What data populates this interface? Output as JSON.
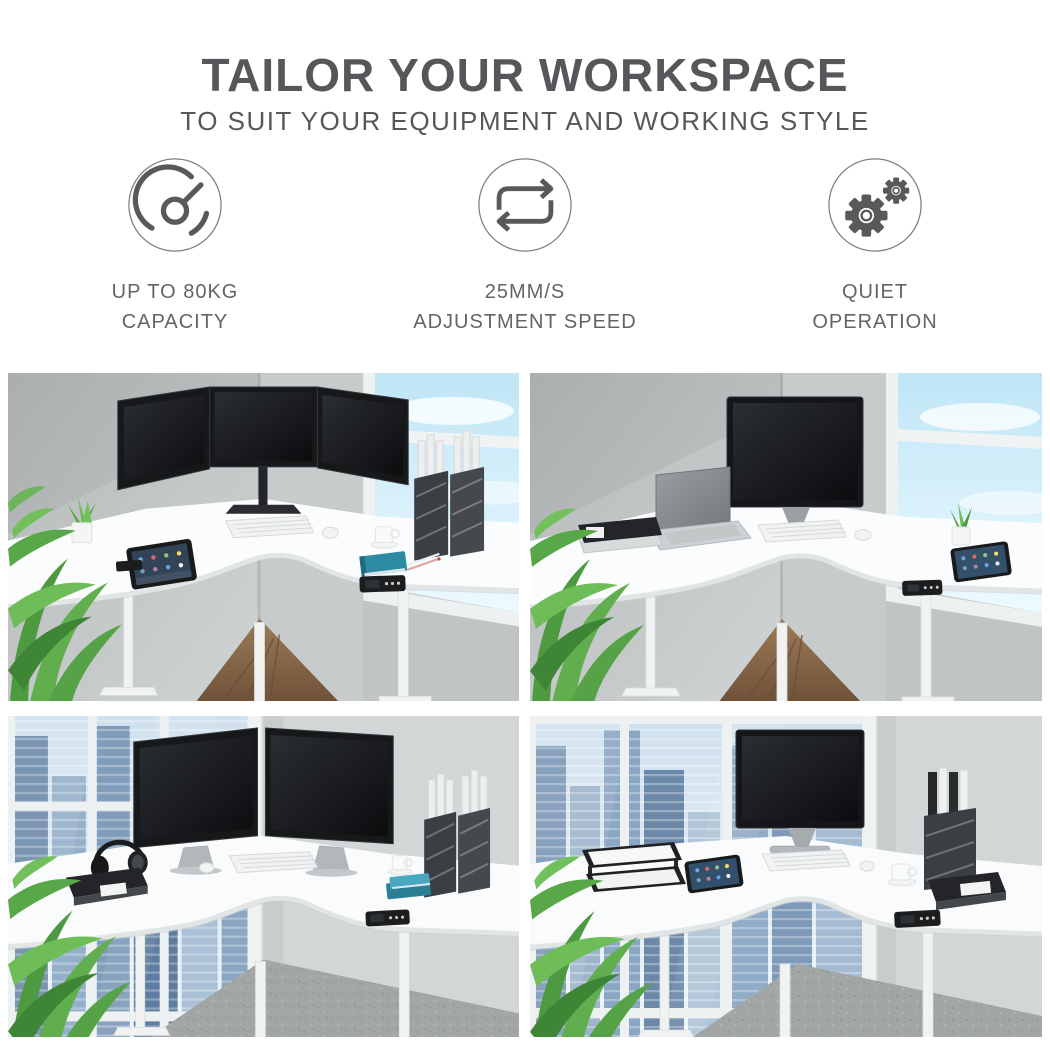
{
  "header": {
    "title": "TAILOR YOUR WORKSPACE",
    "subtitle": "TO SUIT YOUR EQUIPMENT AND WORKING STYLE"
  },
  "features": [
    {
      "icon": "speedometer-icon",
      "line1": "UP TO 80KG",
      "line2": "CAPACITY"
    },
    {
      "icon": "cycle-arrows-icon",
      "line1": "25MM/S",
      "line2": "ADJUSTMENT SPEED"
    },
    {
      "icon": "gears-icon",
      "line1": "QUIET",
      "line2": "OPERATION"
    }
  ],
  "gallery": [
    {
      "name": "triple-monitor-corner-desk",
      "alt": "White corner standing desk with triple monitor mount, tablet, keyboard, coffee cup and magazine files beside a bright window"
    },
    {
      "name": "monitor-and-laptop-corner-desk",
      "alt": "White corner standing desk with a large monitor, open laptop, black binders, small plant and tablet beside a bright window"
    },
    {
      "name": "dual-monitor-corner-desk",
      "alt": "White corner standing desk with two monitors, headphones, binder and magazine files in front of a floor-to-ceiling city window"
    },
    {
      "name": "single-monitor-corner-desk",
      "alt": "White corner standing desk with one monitor, stacked document trays, tablet, coffee cup and binder in front of a floor-to-ceiling city window"
    }
  ],
  "palette": {
    "heading_text": "#56575b",
    "feature_text": "#636468",
    "icon_stroke": "#58595b",
    "sky_blue": "#c2e7f7",
    "city_blue": "#8aa6c2",
    "plant_green": "#5aa749",
    "desk_white": "#fbfcfd",
    "wall_gray": "#c7cbcc"
  }
}
